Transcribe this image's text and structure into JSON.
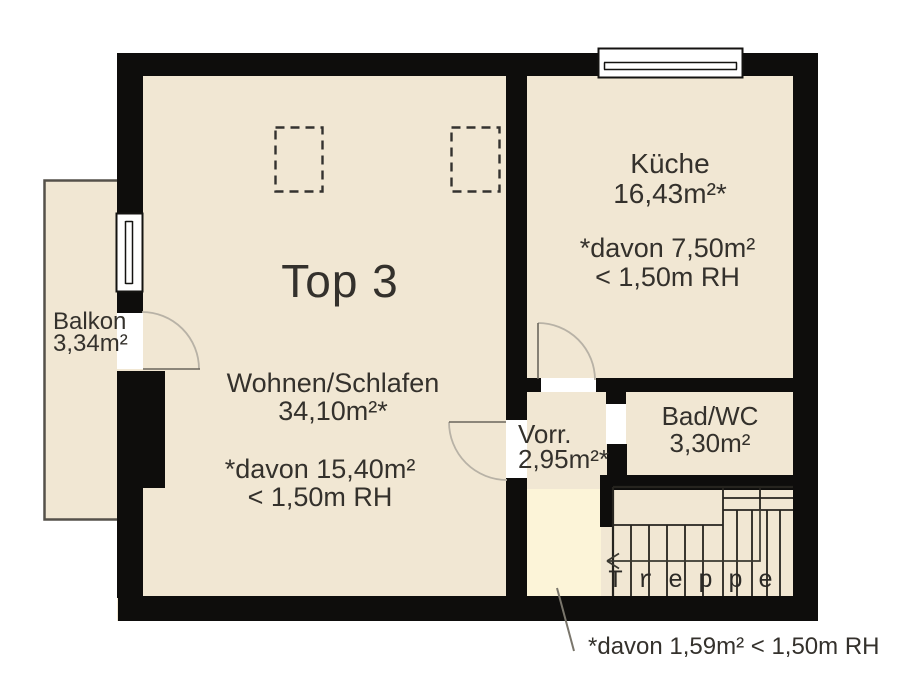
{
  "plan": {
    "unit_label": "Top 3",
    "rooms": {
      "living": {
        "name": "Wohnen/Schlafen",
        "area": "34,10m²*",
        "note1": "*davon 15,40m²",
        "note2": "< 1,50m RH"
      },
      "kitchen": {
        "name": "Küche",
        "area": "16,43m²*",
        "note1": "*davon 7,50m²",
        "note2": "< 1,50m RH"
      },
      "balcony": {
        "name": "Balkon",
        "area": "3,34m²"
      },
      "hallway": {
        "name": "Vorr.",
        "area": "2,95m²*"
      },
      "bath": {
        "name": "Bad/WC",
        "area": "3,30m²"
      },
      "stairs": {
        "name": "Treppe"
      }
    },
    "footnote": "*davon 1,59m² < 1,50m RH",
    "colors": {
      "floor": "#f1e7d3",
      "reduced_height_area": "#fcf4d8",
      "wall": "#0e0d0c",
      "door_swing": "#b8b2a6"
    }
  }
}
